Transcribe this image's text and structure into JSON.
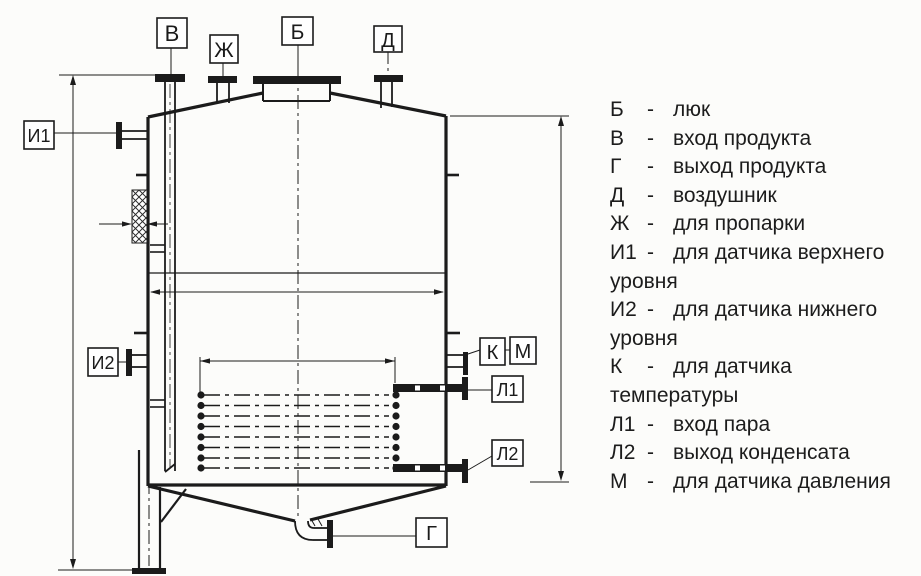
{
  "page": {
    "ink_color": "#1b1b1b",
    "paper_color": "#fcfcfa"
  },
  "drawing": {
    "labels": {
      "V": "В",
      "Zh": "Ж",
      "B": "Б",
      "D": "Д",
      "I1": "И1",
      "I2": "И2",
      "K": "К",
      "M": "М",
      "L1": "Л1",
      "L2": "Л2",
      "G": "Г"
    }
  },
  "legend": {
    "lines": [
      {
        "letter": "Б",
        "dash": "-",
        "text": "люк",
        "cont": false
      },
      {
        "letter": "В",
        "dash": "-",
        "text": "вход продукта",
        "cont": false
      },
      {
        "letter": "Г",
        "dash": "-",
        "text": "выход продукта",
        "cont": false
      },
      {
        "letter": "Д",
        "dash": "-",
        "text": "воздушник",
        "cont": false
      },
      {
        "letter": "Ж",
        "dash": "-",
        "text": "для пропарки",
        "cont": false
      },
      {
        "letter": "И1",
        "dash": "-",
        "text": "для датчика верхнего",
        "cont": false
      },
      {
        "letter": "",
        "dash": "",
        "text": "уровня",
        "cont": true
      },
      {
        "letter": "И2",
        "dash": "-",
        "text": "для датчика нижнего",
        "cont": false
      },
      {
        "letter": "",
        "dash": "",
        "text": "уровня",
        "cont": true
      },
      {
        "letter": "К",
        "dash": "-",
        "text": "для датчика",
        "cont": false
      },
      {
        "letter": "",
        "dash": "",
        "text": "температуры",
        "cont": true
      },
      {
        "letter": "Л1",
        "dash": "-",
        "text": "вход пара",
        "cont": false
      },
      {
        "letter": "Л2",
        "dash": "-",
        "text": "выход конденсата",
        "cont": false
      },
      {
        "letter": "М",
        "dash": "-",
        "text": "для датчика давления",
        "cont": false
      }
    ]
  }
}
